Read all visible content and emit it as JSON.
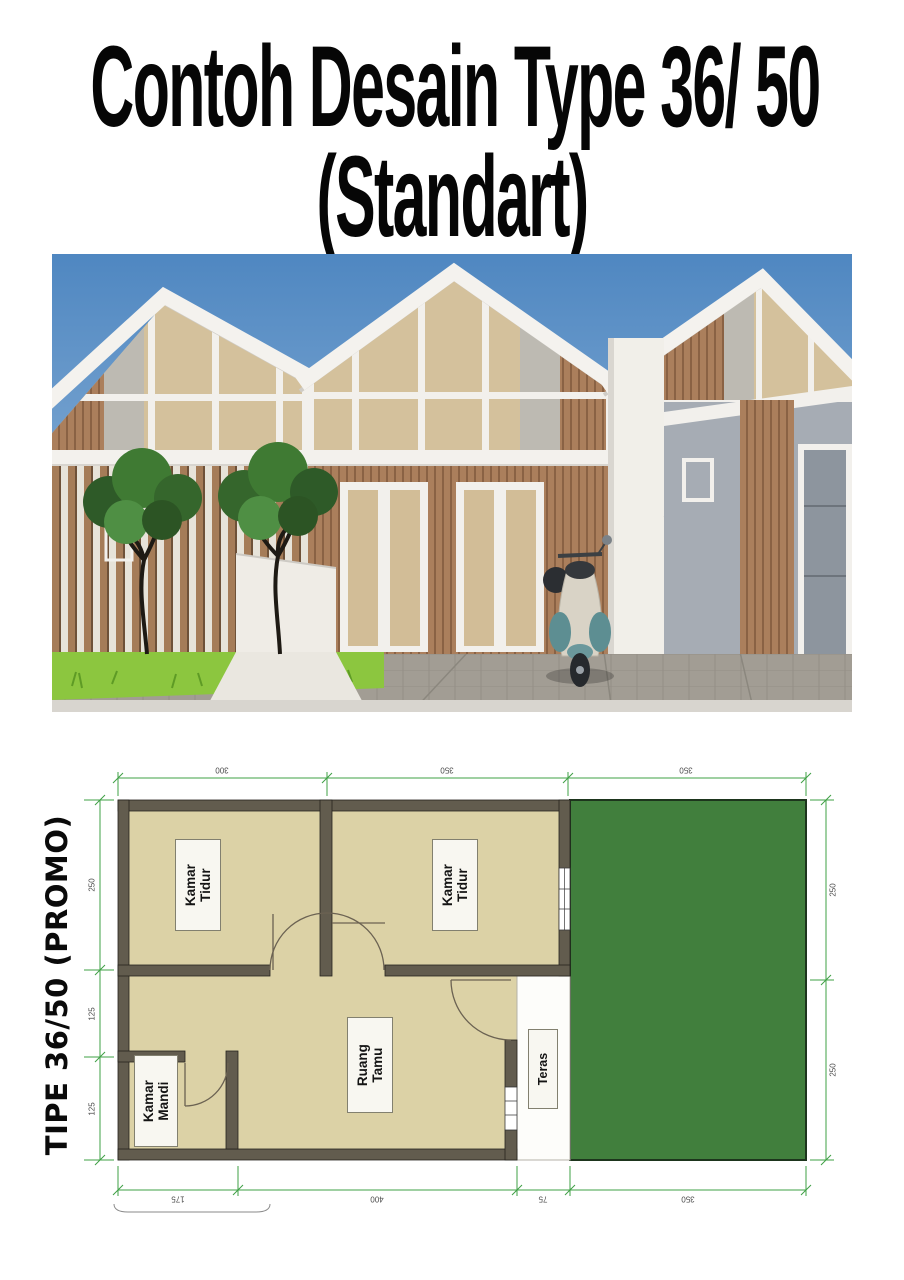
{
  "title": {
    "line1": "Contoh Desain Type 36/ 50",
    "line2": "(Standart)"
  },
  "photo": {
    "description": "3D render of minimalist gable-roof row houses with wood slats, two frangipani trees, and a scooter",
    "colors": {
      "sky_top": "#4f87c1",
      "sky_bottom": "#93b7da",
      "roof_white": "#f4f2ee",
      "gable_glass": "#d4c19c",
      "wood": "#ab7f5c",
      "concrete": "#a6acb4",
      "grass": "#8cc63f",
      "paver": "#a29d94",
      "scooter_teal": "#5d8e92",
      "scooter_cream": "#d9d3c6"
    }
  },
  "plan": {
    "side_title": "TIPE 36/50 (PROMO)",
    "rooms": {
      "bedroom1": {
        "line1": "Kamar",
        "line2": "Tidur"
      },
      "bedroom2": {
        "line1": "Kamar",
        "line2": "Tidur"
      },
      "bathroom": {
        "line1": "Kamar",
        "line2": "Mandi"
      },
      "living": {
        "line1": "Ruang",
        "line2": "Tamu"
      },
      "terrace": {
        "line1": "Teras",
        "line2": ""
      }
    },
    "dimensions": {
      "top": [
        "300",
        "350",
        "350"
      ],
      "bottom": [
        "175",
        "400",
        "75",
        "350"
      ],
      "left": [
        "250",
        "125",
        "125"
      ],
      "right": [
        "250",
        "250"
      ]
    },
    "colors": {
      "yard": "#417f3d",
      "floor": "#dcd2a6",
      "wall": "#625c4e",
      "dimension": "#3fa046",
      "terrace_floor": "#fdfdfa"
    }
  }
}
